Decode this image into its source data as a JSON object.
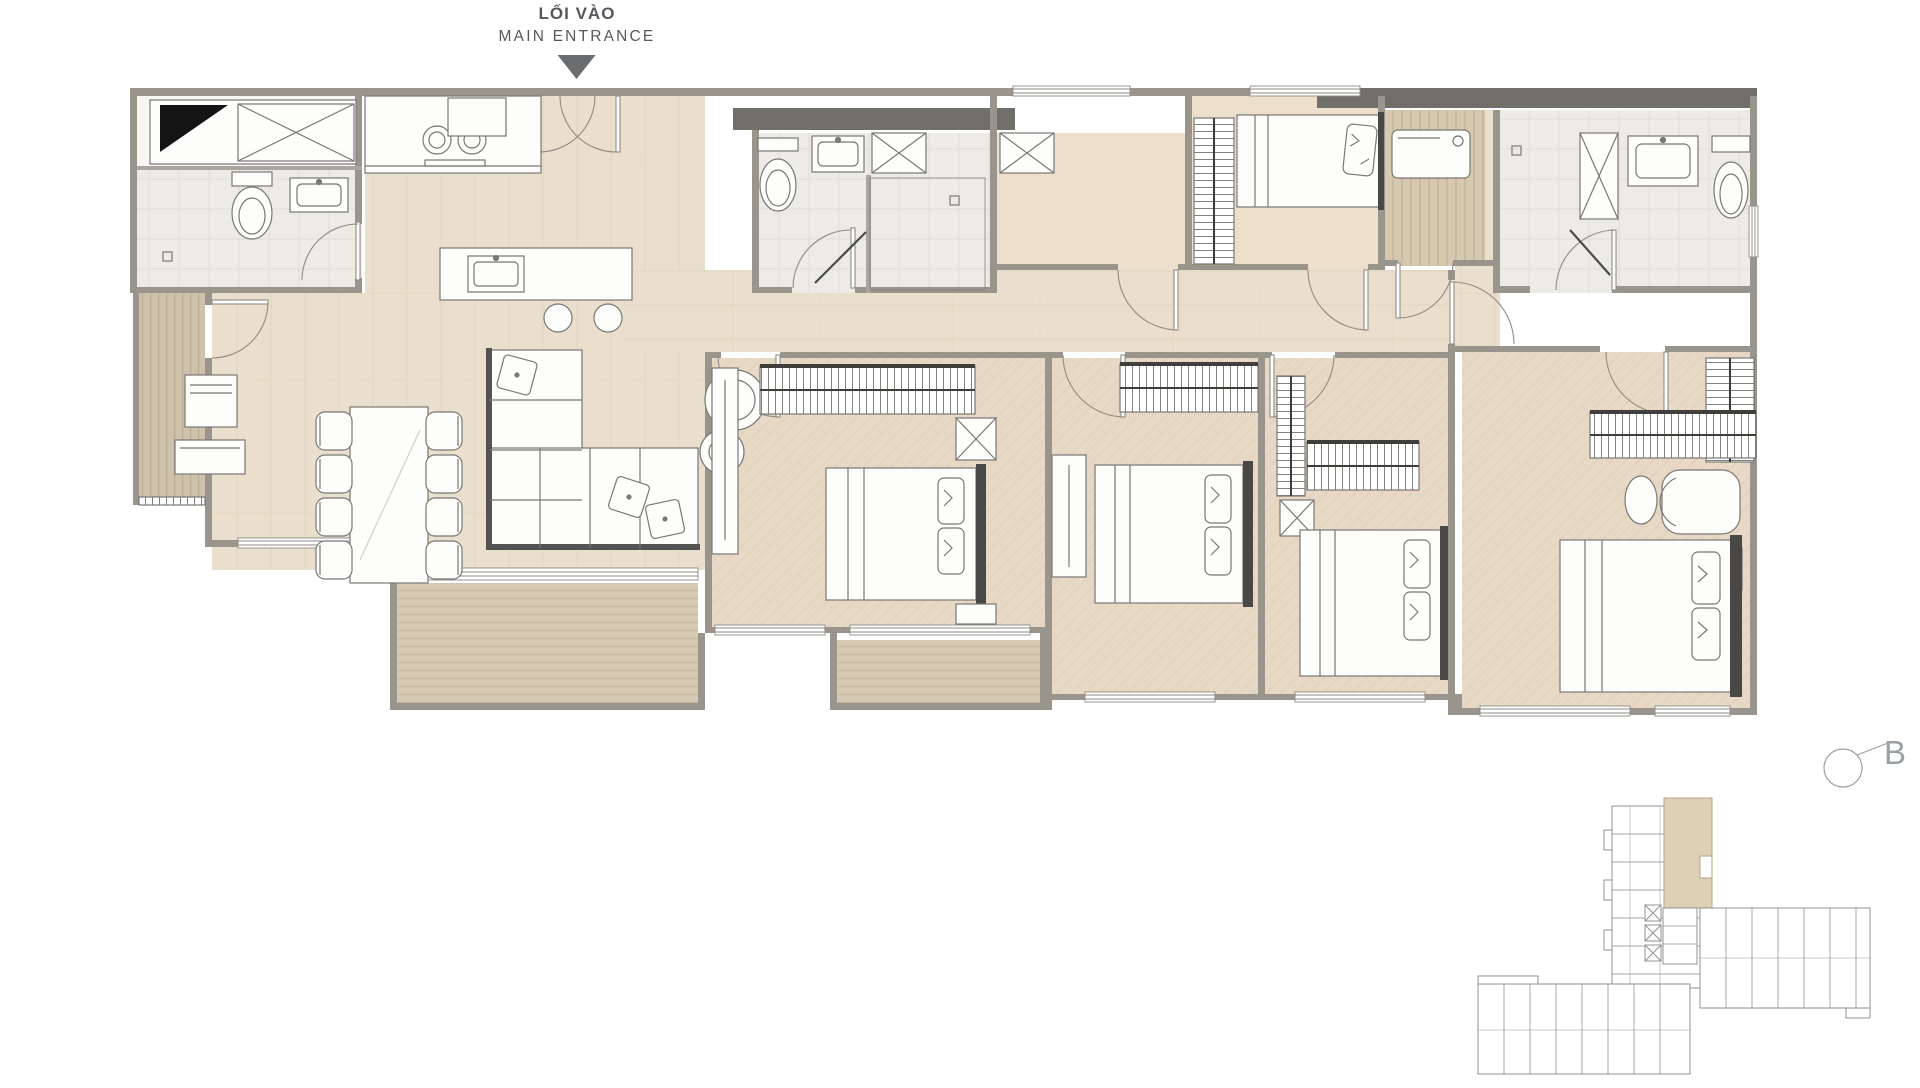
{
  "entrance": {
    "label_vi": "LỐI VÀO",
    "label_en": "MAIN ENTRANCE"
  },
  "section_marker": {
    "label": "B"
  },
  "palette": {
    "background": "#ffffff",
    "wall": "#9a958c",
    "wall_dark": "#716f6a",
    "arrow": "#6a6c6e",
    "label_text": "#57585c",
    "marker_text": "#9ba0a4",
    "floor_plank": "#e9dfcc",
    "floor_herringbone": "#e8d9c6",
    "floor_tile": "#edebe6",
    "deck": "#d7cab4",
    "deck_dark": "#cfc2ab",
    "furniture_fill": "#fdfdfc",
    "furniture_outline": "#7a7774",
    "accent_dark": "#4a4846",
    "keyplan_line": "#8f9193",
    "keyplan_highlight": "#ddd0b4"
  },
  "rooms": [
    "entrance-foyer",
    "kitchen",
    "dining-area",
    "living-room",
    "bathroom-1",
    "bathroom-2",
    "bathroom-3",
    "bedroom-1",
    "bedroom-2",
    "bedroom-3",
    "bedroom-small",
    "den",
    "utility-room",
    "master-bedroom",
    "master-walk-in-closet",
    "corridor",
    "balcony-left",
    "balcony-living",
    "balcony-middle"
  ]
}
